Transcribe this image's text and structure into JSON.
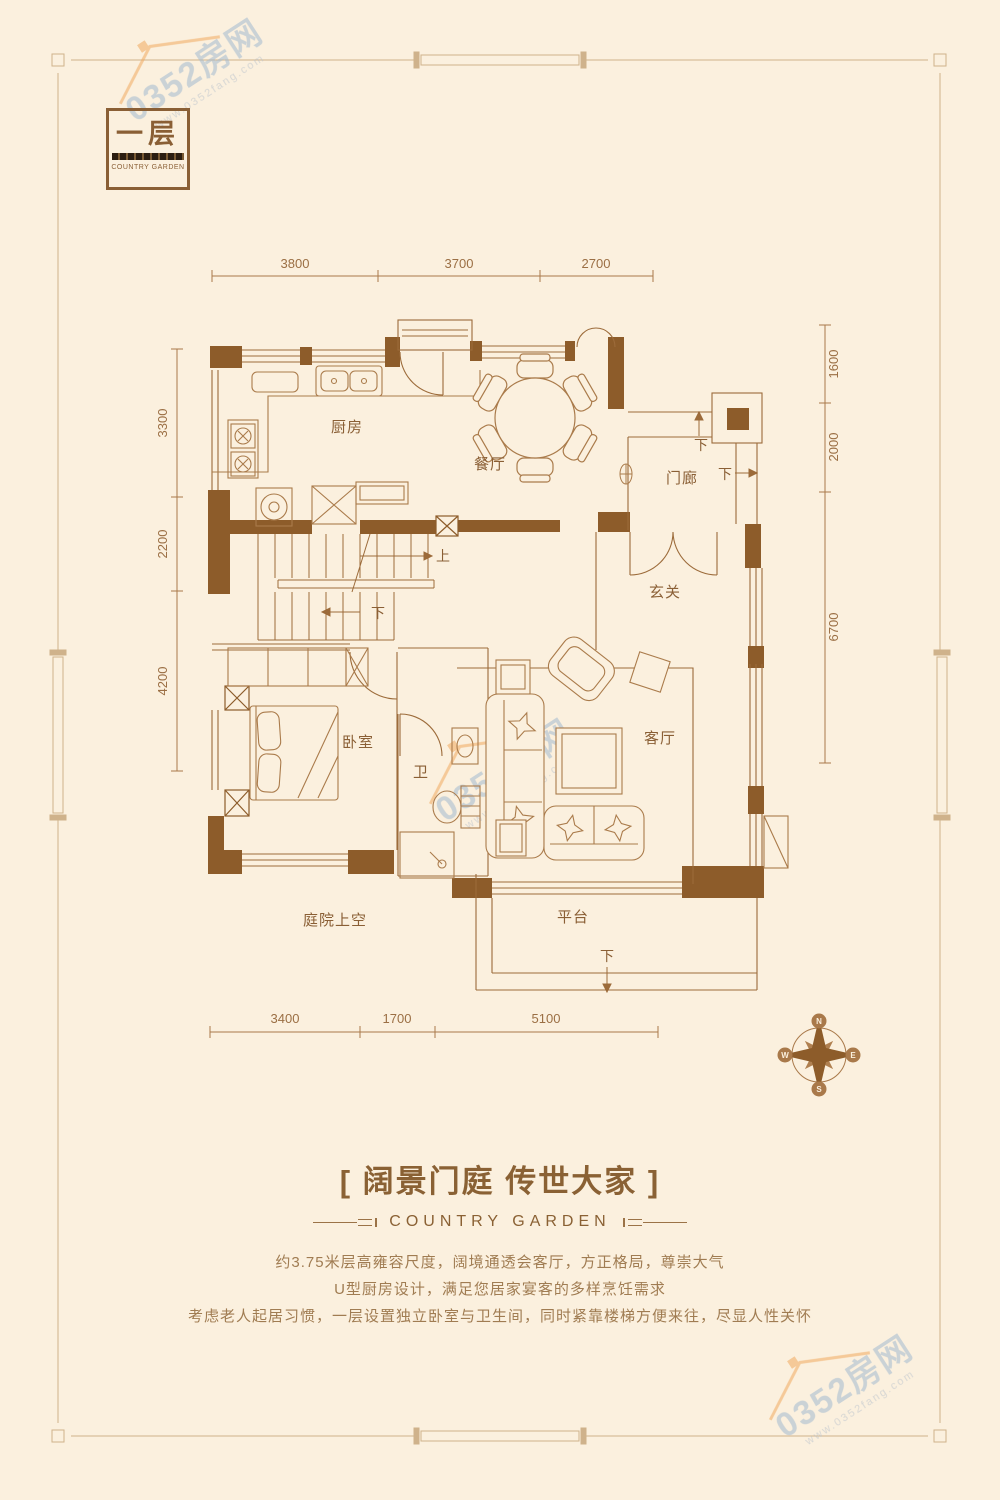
{
  "logo": {
    "floor_label": "一层",
    "brand": "COUNTRY GARDEN"
  },
  "watermark": {
    "text": "0352房网",
    "url": "www.0352fang.com"
  },
  "plan": {
    "rooms": {
      "kitchen": "厨房",
      "dining": "餐厅",
      "porch": "门廊",
      "foyer": "玄关",
      "bedroom": "卧室",
      "bath": "卫",
      "living": "客厅",
      "courtyard": "庭院上空",
      "terrace": "平台"
    },
    "stairs": {
      "up": "上",
      "down": "下"
    },
    "dimensions": {
      "top": [
        "3800",
        "3700",
        "2700"
      ],
      "bottom": [
        "3400",
        "1700",
        "5100"
      ],
      "left": [
        "3300",
        "2200",
        "4200"
      ],
      "right": [
        "1600",
        "2000",
        "6700"
      ]
    },
    "compass": {
      "n": "N",
      "e": "E",
      "s": "S",
      "w": "W"
    }
  },
  "footer": {
    "title": "[ 阔景门庭 传世大家 ]",
    "subtitle": "COUNTRY GARDEN",
    "description": [
      "约3.75米层高雍容尺度，阔境通透会客厅，方正格局，尊崇大气",
      "U型厨房设计，满足您居家宴客的多样烹饪需求",
      "考虑老人起居习惯，一层设置独立卧室与卫生间，同时紧靠楼梯方便来往，尽显人性关怀"
    ]
  }
}
